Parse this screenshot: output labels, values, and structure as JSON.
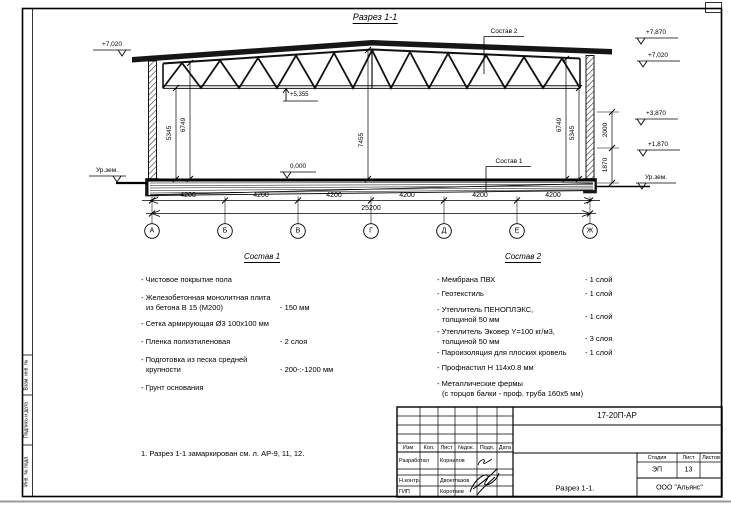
{
  "section_title": "Разрез 1-1",
  "elevations": {
    "left_eave": "+7,020",
    "left_ground": "Ур.зем.",
    "right_ridge": "+7,870",
    "right_eave": "+7,020",
    "right_mid_upper": "+3,870",
    "right_mid_lower": "+1,870",
    "right_ground": "Ур.зем.",
    "floor": "0,000",
    "truss_bottom": "+5,355"
  },
  "dimensions": {
    "bays": [
      "4200",
      "4200",
      "4200",
      "4200",
      "4200",
      "4200"
    ],
    "total": "25200",
    "v_left_inner": "5345",
    "v_left_outer": "6749",
    "v_center": "7455",
    "v_right_outer": "6749",
    "v_right_inner": "5345",
    "r_upper": "2000",
    "r_lower": "1870"
  },
  "axes": [
    "А",
    "Б",
    "В",
    "Г",
    "Д",
    "Е",
    "Ж"
  ],
  "callouts": {
    "sostav1": "Состав 1",
    "sostav2": "Состав 2"
  },
  "sostav1": {
    "heading": "Состав 1",
    "items": [
      {
        "line1": "- Чистовое покрытие пола",
        "line2": "",
        "value": ""
      },
      {
        "line1": "- Железобетонная  монолитная плита",
        "line2": "из бетона В 15 (М200)",
        "value": "- 150 мм"
      },
      {
        "line1": "- Сетка армирующая Ø3 100х100 мм",
        "line2": "",
        "value": ""
      },
      {
        "line1": "- Пленка полиэтиленовая",
        "line2": "",
        "value": "- 2 слоя"
      },
      {
        "line1": "- Подготовка из песка средней",
        "line2": "крупности",
        "value": "- 200-:-1200 мм"
      },
      {
        "line1": "- Грунт основания",
        "line2": "",
        "value": ""
      }
    ]
  },
  "sostav2": {
    "heading": "Состав 2",
    "items": [
      {
        "line1": "- Мембрана ПВХ",
        "line2": "",
        "value": "- 1 слой"
      },
      {
        "line1": "- Геотекстиль",
        "line2": "",
        "value": "- 1 слой"
      },
      {
        "line1": "- Утеплитель ПЕНОПЛЭКС,",
        "line2": "толщиной 50 мм",
        "value": "- 1 слой"
      },
      {
        "line1": "- Утеплитель Эковер Y=100 кг/м3,",
        "line2": "толщиной 50 мм",
        "value": "- 3 слоя"
      },
      {
        "line1": "- Пароизоляция для плоских кровель",
        "line2": "",
        "value": "- 1 слой"
      },
      {
        "line1": "- Профнастил Н 114х0.8 мм",
        "line2": "",
        "value": ""
      },
      {
        "line1": "- Металлические фермы",
        "line2": "(с торцов балки - проф. труба 160х5 мм)",
        "value": ""
      }
    ]
  },
  "note": "1. Разрез 1-1 замаркирован см. л. АР-9, 11, 12.",
  "title_block": {
    "doc_code": "17-20П-АР",
    "header": {
      "izm": "Изм",
      "kol": "Кол.",
      "list": "Лист",
      "ndoc": "№док.",
      "podp": "Подп.",
      "data": "Дата"
    },
    "rows": [
      {
        "role": "Разработал",
        "name": "Корнилов"
      },
      {
        "role": "Н.контр.",
        "name": "Двоеглазов"
      },
      {
        "role": "ГИП",
        "name": "Коротаев"
      }
    ],
    "stage_label": "Стадия",
    "sheet_label": "Лист",
    "sheets_label": "Листов",
    "stage": "ЭП",
    "sheet": "13",
    "sheets": "",
    "drawing_title": "Разрез 1-1.",
    "company": "ООО \"Альянс\""
  },
  "frame_stamps": {
    "top": "Взам. инв. №",
    "mid": "Подпись и дата",
    "bottom": "Инв. № подл."
  }
}
